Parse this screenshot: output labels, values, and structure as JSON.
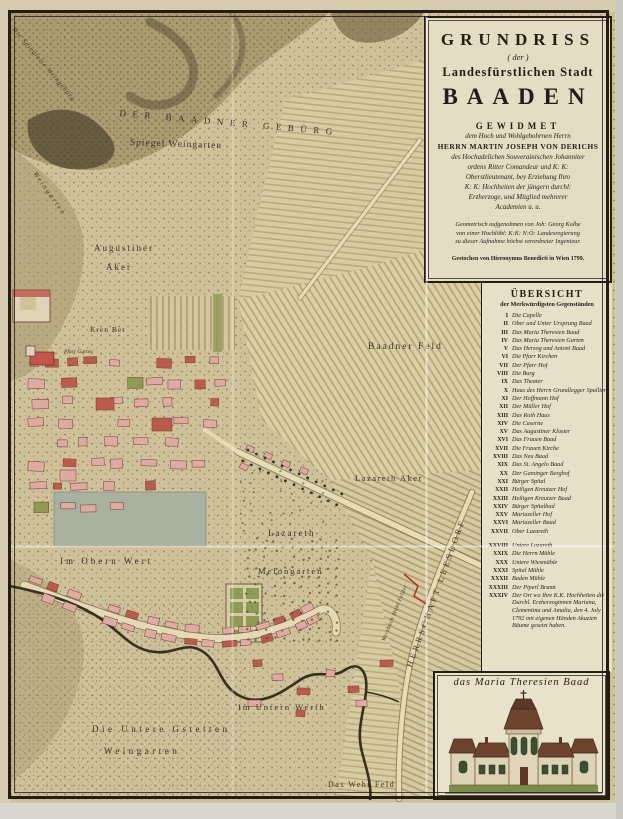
{
  "cartouche": {
    "title1": "GRUNDRISS",
    "title2": "( der )",
    "title3": "Landesfürstlichen Stadt",
    "title4": "BAADEN",
    "gewidmet": "GEWIDMET",
    "dedication_lines": [
      "dem Hoch und Wohlgebohrnen Herrn",
      "HERRN MARTIN JOSEPH VON DERICHS",
      "des Hochadelichen Souverainischen Johanniter",
      "ordens Ritter Comandeur und K: K:",
      "Oberstlieutenant, bey Erziehung Ihro",
      "K: K: Hochheiten der jüngern durchl:",
      "Erzherzoge, und Mitglied mehrerer",
      "Academien u. u."
    ],
    "surveyor_lines": [
      "Geometrisch aufgenohmen von Joh: Georg Kolbe",
      "von einer Hochlöbl: K:K: N:Ö: Landesregierung",
      "zu dieser Aufnahme höchst verordneter Ingenieur."
    ],
    "engraver_line": "Gestochen von Hieronymus Benedicti in Wien 1799."
  },
  "legend": {
    "title": "ÜBERSICHT",
    "subtitle": "der Merkwürdigsten Gegenständen",
    "entries": [
      {
        "n": "I",
        "t": "Die Capelle"
      },
      {
        "n": "II",
        "t": "Ober und Unter Ursprung Baad"
      },
      {
        "n": "III",
        "t": "Das Maria Theresien Baad"
      },
      {
        "n": "IV",
        "t": "Das Maria Theresien Garten"
      },
      {
        "n": "V",
        "t": "Das Herzog und Antoni Baad"
      },
      {
        "n": "VI",
        "t": "Die Pfarr Kirchen"
      },
      {
        "n": "VII",
        "t": "Der Pfarr Hof"
      },
      {
        "n": "VIII",
        "t": "Die Burg"
      },
      {
        "n": "IX",
        "t": "Das Theater"
      },
      {
        "n": "X",
        "t": "Haus des Herrn Grundlegger Spallier"
      },
      {
        "n": "XI",
        "t": "Der Hoffmann Hof"
      },
      {
        "n": "XII",
        "t": "Der Müller Hof"
      },
      {
        "n": "XIII",
        "t": "Das Roth Haus"
      },
      {
        "n": "XIV",
        "t": "Die Caserne"
      },
      {
        "n": "XV",
        "t": "Das Augustiner Kloster"
      },
      {
        "n": "XVI",
        "t": "Das Frauen Baad"
      },
      {
        "n": "XVII",
        "t": "Die Frauen Kirche"
      },
      {
        "n": "XVIII",
        "t": "Das Neu Baad"
      },
      {
        "n": "XIX",
        "t": "Das St. Angelo Baad"
      },
      {
        "n": "XX",
        "t": "Der Gaminger Berghof"
      },
      {
        "n": "XXI",
        "t": "Bürger Spital"
      },
      {
        "n": "XXII",
        "t": "Heiligen Kreutzer Hof"
      },
      {
        "n": "XXIII",
        "t": "Heiligen Kreutzer Baad"
      },
      {
        "n": "XXIV",
        "t": "Bürger Spitalbad"
      },
      {
        "n": "XXV",
        "t": "Mariazeller Hof"
      },
      {
        "n": "XXVI",
        "t": "Mariazeller Baad"
      },
      {
        "n": "XXVII",
        "t": "Ober Lazareth"
      },
      {
        "n": "XXVIII",
        "t": "Untere Lazareth"
      },
      {
        "n": "XXIX",
        "t": "Die Herrn Mühle"
      },
      {
        "n": "XXX",
        "t": "Untere Wiesmühle"
      },
      {
        "n": "XXXI",
        "t": "Spital Mühle"
      },
      {
        "n": "XXXII",
        "t": "Baden Mühle"
      },
      {
        "n": "XXXIII",
        "t": "Der Piperl Brunn"
      },
      {
        "n": "XXXIV",
        "t": "Der Ort wo Ihre K.K. Hochheiten die Durchl. Erzherzoginnen Mariana, Clementina und Amalia, den 4. July 1792 mit eigenen Händen Akazien Bäume gesetzt haben."
      }
    ]
  },
  "vignette": {
    "caption": "das Maria Theresien Baad"
  },
  "map_labels": [
    {
      "t": "Die Spiegleite Weingebürg",
      "x": 16,
      "y": 26,
      "rot": 50,
      "fs": 6.5,
      "ls": 1,
      "it": true
    },
    {
      "t": "DER BAADNER GEBÜRG",
      "x": 120,
      "y": 108,
      "rot": 5,
      "fs": 9,
      "ls": 6.5
    },
    {
      "t": "Spiegel Weingarten",
      "x": 130,
      "y": 138,
      "rot": 2,
      "fs": 9.5,
      "ls": 1
    },
    {
      "t": "Weingarten",
      "x": 38,
      "y": 170,
      "rot": 55,
      "fs": 7,
      "ls": 2,
      "it": true
    },
    {
      "t": "Augustiner",
      "x": 94,
      "y": 243,
      "fs": 9,
      "ls": 2
    },
    {
      "t": "Aker",
      "x": 106,
      "y": 262,
      "fs": 9,
      "ls": 2
    },
    {
      "t": "Kren Bet",
      "x": 90,
      "y": 325,
      "fs": 7.5,
      "ls": 1
    },
    {
      "t": "Pfarr Garten",
      "x": 64,
      "y": 349,
      "fs": 5.5,
      "ls": 0,
      "it": true
    },
    {
      "t": "Baadner  Feld",
      "x": 368,
      "y": 342,
      "fs": 9.5,
      "ls": 2
    },
    {
      "t": "Lazareth  Aker",
      "x": 355,
      "y": 473,
      "fs": 8.5,
      "ls": 1.5
    },
    {
      "t": "Lazareth",
      "x": 268,
      "y": 528,
      "fs": 9,
      "ls": 2
    },
    {
      "t": "Melongarten",
      "x": 258,
      "y": 566,
      "fs": 8.5,
      "ls": 2
    },
    {
      "t": "Im Obern Wert",
      "x": 60,
      "y": 556,
      "fs": 9,
      "ls": 3
    },
    {
      "t": "HERRSCHAFT LEESDORF",
      "x": 404,
      "y": 665,
      "rot": -70,
      "fs": 8.5,
      "ls": 3
    },
    {
      "t": "Wersbach Mühl Felder",
      "x": 381,
      "y": 640,
      "rot": -68,
      "fs": 5.5,
      "ls": 0.5,
      "it": true
    },
    {
      "t": "Im Untern Werth",
      "x": 238,
      "y": 702,
      "fs": 8.5,
      "ls": 2
    },
    {
      "t": "Die Untere Gstetten",
      "x": 92,
      "y": 724,
      "fs": 9,
      "ls": 3.5
    },
    {
      "t": "Weingarten",
      "x": 104,
      "y": 746,
      "fs": 9,
      "ls": 3.5
    },
    {
      "t": "Das Wehr Feld",
      "x": 328,
      "y": 780,
      "fs": 8,
      "ls": 1.5
    }
  ],
  "colors": {
    "parchment": "#cfc199",
    "panel_cream": "#e7dfc8",
    "cartouche_cream": "#e4dcc3",
    "ink": "#241d12",
    "label_ink": "#3b3322",
    "town_pink": "#dfaaa0",
    "roof_red": "#bd5a4e",
    "garden_olive": "#8f9a55",
    "hill_olive": "#9b8c60",
    "hill_dark": "#584e34",
    "meadow_gray": "#a9b1a0",
    "river_dark": "#37301e",
    "boundary_red": "#b23325",
    "stripe_light": "#dbcfa6",
    "stripe_dark": "#b4a678"
  }
}
